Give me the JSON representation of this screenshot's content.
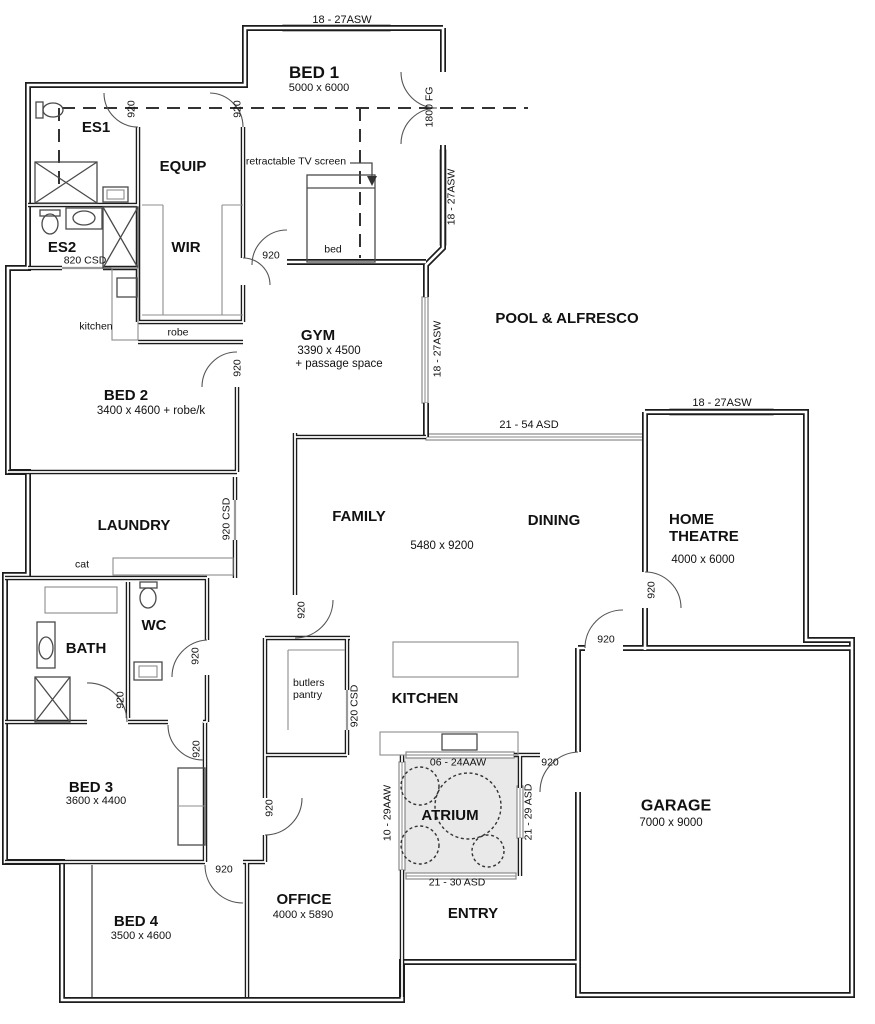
{
  "meta": {
    "type": "architectural floor plan"
  },
  "colors": {
    "wall": "#1c1c1c",
    "window": "#8a8a8a",
    "atrium_fill": "#e9e9e9",
    "background": "#ffffff",
    "text": "#111111"
  },
  "rooms": {
    "bed1": {
      "name": "BED 1",
      "dims": "5000 x 6000"
    },
    "es1": {
      "name": "ES1"
    },
    "equip": {
      "name": "EQUIP"
    },
    "es2": {
      "name": "ES2"
    },
    "wir": {
      "name": "WIR"
    },
    "gym": {
      "name": "GYM",
      "dims": "3390 x 4500",
      "note": "+ passage space"
    },
    "pool_alfresco": {
      "name": "POOL & ALFRESCO"
    },
    "bed2": {
      "name": "BED 2",
      "dims": "3400 x 4600 + robe/k"
    },
    "laundry": {
      "name": "LAUNDRY"
    },
    "family": {
      "name": "FAMILY"
    },
    "dining": {
      "name": "DINING"
    },
    "living": {
      "dims": "5480 x 9200"
    },
    "home_theatre": {
      "name": "HOME THEATRE",
      "dims": "4000 x 6000"
    },
    "bath": {
      "name": "BATH"
    },
    "wc": {
      "name": "WC"
    },
    "butlers_pantry": {
      "name": "butlers pantry"
    },
    "kitchen": {
      "name": "KITCHEN"
    },
    "atrium": {
      "name": "ATRIUM"
    },
    "bed3": {
      "name": "BED 3",
      "dims": "3600 x 4400"
    },
    "garage": {
      "name": "GARAGE",
      "dims": "7000 x 9000"
    },
    "bed4": {
      "name": "BED 4",
      "dims": "3500 x 4600"
    },
    "office": {
      "name": "OFFICE",
      "dims": "4000 x 5890"
    },
    "entry": {
      "name": "ENTRY"
    }
  },
  "features": {
    "bed": "bed",
    "robe": "robe",
    "kitchenette": "kitchen",
    "cat_door": "cat",
    "tv": "retractable TV screen"
  },
  "openings": {
    "door_920": "920",
    "csd_920": "920 CSD",
    "csd_820": "820 CSD",
    "fg_1800": "1800 FG",
    "asw_18_27": "18 - 27ASW",
    "asd_21_54": "21 - 54 ASD",
    "aaw_06_24": "06 - 24AAW",
    "aaw_10_29": "10 - 29AAW",
    "asd_21_29": "21 - 29 ASD",
    "asd_21_30": "21 - 30 ASD"
  }
}
